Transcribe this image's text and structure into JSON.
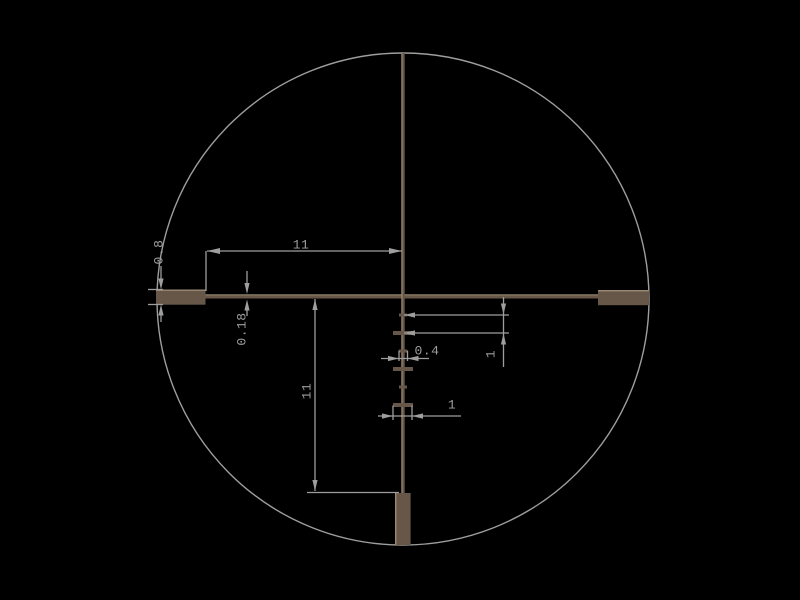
{
  "diagram": {
    "type": "riflescope-reticle-dimension-drawing",
    "background_color": "#000000",
    "reticle_color": "#675748",
    "reticle_highlight_color": "#9a8a74",
    "dimension_color": "#9e9e9e",
    "field_of_view": "circle",
    "posts": [
      "left",
      "right",
      "bottom"
    ],
    "hash_marks_below_center": {
      "count": 6,
      "pattern": "alternating small and wide"
    }
  },
  "dimension_labels": {
    "top_span": "11",
    "left_post_thickness": "0.8",
    "wire_thickness": "0.18",
    "center_to_bottom_post": "11",
    "hash_spacing": "1",
    "small_hash_width": "0.4",
    "large_hash_width": "1"
  }
}
